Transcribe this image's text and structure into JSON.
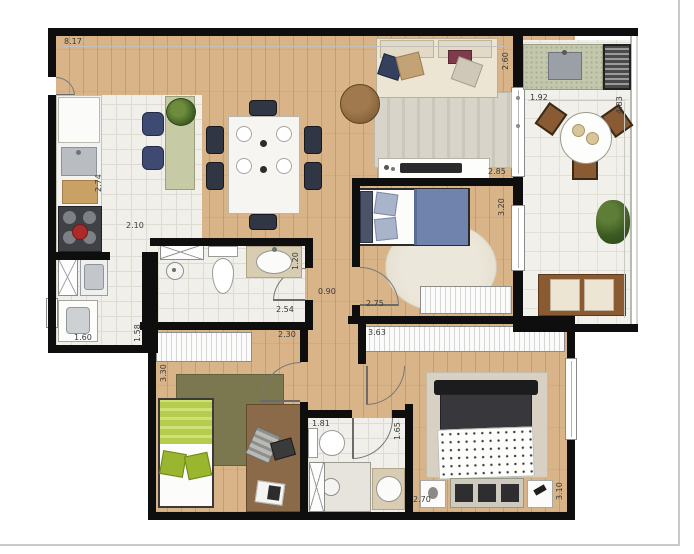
{
  "plan": {
    "type": "apartment-floor-plan",
    "unit": "m",
    "dimensions": {
      "living_top_width": "8.17",
      "kitchen_counter_depth": "2.74",
      "kitchen_width": "2.10",
      "laundry_width": "1.60",
      "laundry_depth": "1.58",
      "bath1_width": "2.54",
      "bath1_depth": "1.20",
      "hall_width": "0.90",
      "bedroom1_width": "2.75",
      "bedroom1_depth": "3.20",
      "tv_wall_width": "2.85",
      "balcony_counter_side": "2.60",
      "balcony_width": "1.92",
      "balcony_depth": "4.83",
      "bedroom2_width": "2.30",
      "bedroom2_depth": "3.30",
      "master_wardrobe_width": "3.63",
      "bath2_width": "1.81",
      "bath2_depth": "1.65",
      "master_width": "2.70",
      "master_depth": "3.10"
    },
    "colors": {
      "wall": "#0e0e0e",
      "wood": "#d9b488",
      "woodline": "#c79d6f",
      "tile": "#f0efea",
      "tileline": "#dedbd2",
      "label": "#3a3a3a",
      "green": "#c6cba6",
      "blue": "#47548c",
      "lightblue": "#a9b4cb",
      "bluespread": "#6f83ad",
      "lime": "#b5cc4e",
      "red": "#ab2b2b",
      "brown": "#8a5a33",
      "cream": "#ece5d4",
      "frame": "#c9c9c9"
    }
  }
}
